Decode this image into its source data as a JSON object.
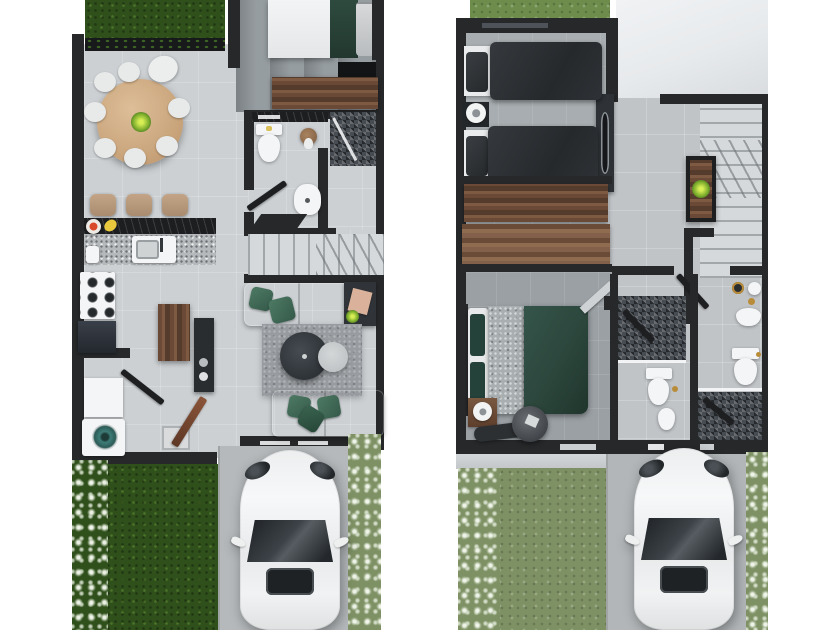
{
  "image": {
    "kind": "real-estate floor plan, photorealistic top-down 3D render",
    "panels": 2,
    "text_visible": "none"
  },
  "palette": {
    "wall": "#26282a",
    "floor-light": "#ccd0d3",
    "floor-dark": "#969da1",
    "stair": "#d6d9db",
    "grass-dark": "#2f4f1b",
    "grass-sage": "#7e9164",
    "wood": "#6a4a36",
    "wood-table": "#d2ac80",
    "granite-light": "#b5b9bb",
    "granite-dark": "#1c1e20",
    "rug": "#989ca0",
    "sofa-gray": "#b6babc",
    "pillow-green": "#3f6b55",
    "duvet-charcoal": "#2f3235",
    "duvet-green": "#2c463c",
    "driveway": "#b5b9bb",
    "car-white": "#f2f3f4",
    "glass-dark": "#24282c",
    "washer-teal": "#3e7d78",
    "accent-gold": "#b98c3a"
  },
  "floors": [
    {
      "id": "first-floor",
      "position": "left panel",
      "rooms": [
        "front garden",
        "dining room",
        "kitchen",
        "bedroom",
        "guest bathroom with shower",
        "stairs",
        "living room",
        "laundry room",
        "entry hall",
        "backyard lawn",
        "driveway"
      ],
      "furniture": [
        "round wooden dining table with eight chairs and centerpiece plant",
        "breakfast bar with three stools",
        "granite counter with sink",
        "six-burner stove",
        "dark appliance",
        "wooden island",
        "tall dark cabinet",
        "double bed with green throw",
        "wooden dresser",
        "toilet",
        "pedestal sink",
        "mosaic-tiled shower",
        "two gray sofas with green cushions",
        "round dark coffee table with white side table",
        "speckled area rug",
        "side table with plant",
        "washing machine with teal drum",
        "utility table",
        "doormat",
        "white car on driveway",
        "shrub borders"
      ]
    },
    {
      "id": "second-floor",
      "position": "right panel",
      "rooms": [
        "kids bedroom with two single beds",
        "built-in closet corridor",
        "master bedroom",
        "ensuite bathroom",
        "second bathroom",
        "stair landing with console",
        "open void over first floor",
        "garden",
        "driveway"
      ],
      "furniture": [
        "two single beds with charcoal duvets",
        "shared nightstand with round lamp",
        "wardrobe with mirror",
        "two wood-front closets",
        "double bed with green duvet and gray throw",
        "nightstand with lamp",
        "dark chaise bench",
        "round pouf",
        "console table with plant",
        "two toilets",
        "bidet",
        "two mosaic-tiled showers",
        "washbasin",
        "vanity accessories",
        "white car on driveway",
        "shrub borders"
      ]
    }
  ]
}
